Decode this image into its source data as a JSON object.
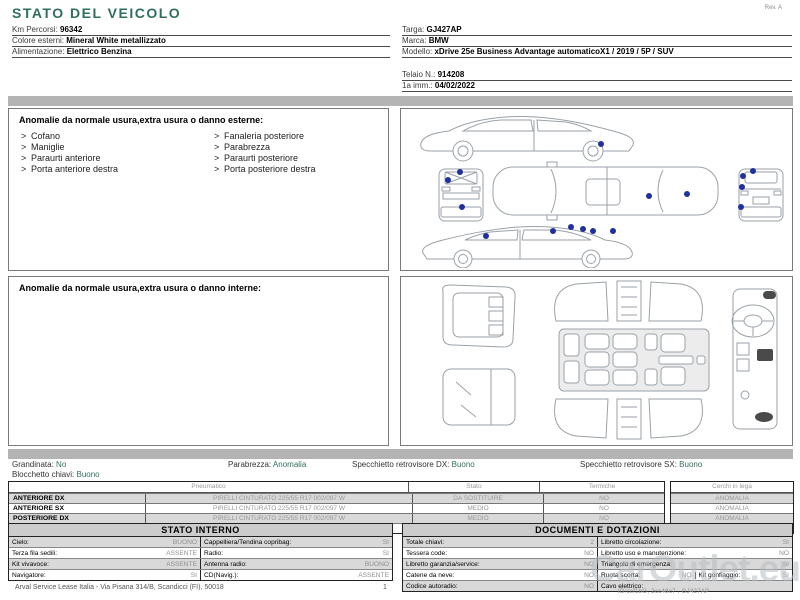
{
  "page": {
    "rev": "Rev. A"
  },
  "title": "STATO DEL VEICOLO",
  "info_left": [
    {
      "label": "Km Percorsi:",
      "value": "96342"
    },
    {
      "label": "Colore esterni:",
      "value": "Mineral White metallizzato"
    },
    {
      "label": "Alimentazione:",
      "value": "Elettrico Benzina"
    }
  ],
  "info_right": [
    {
      "label": "Targa:",
      "value": "GJ427AP"
    },
    {
      "label": "Marca:",
      "value": "BMW"
    },
    {
      "label": "Modello:",
      "value": "xDrive 25e Business Advantage automaticoX1 / 2019 / 5P / SUV"
    },
    {
      "label": "Telaio N.:",
      "value": "914208"
    },
    {
      "label": "1a imm.:",
      "value": "04/02/2022"
    }
  ],
  "exterior": {
    "heading": "Anomalie da normale usura,extra usura o danno esterne:",
    "marker": ">",
    "items_left": [
      "Cofano",
      "Maniglie",
      "Paraurti anteriore",
      "Porta anteriore destra"
    ],
    "items_right": [
      "Fanaleria posteriore",
      "Parabrezza",
      "Paraurti posteriore",
      "Porta posteriore destra"
    ]
  },
  "interior": {
    "heading": "Anomalie da normale usura,extra usura o danno interne:"
  },
  "summary": {
    "grandinata_label": "Grandinata:",
    "grandinata_value": "No",
    "blocchetto_label": "Blocchetto chiavi:",
    "blocchetto_value": "Buono",
    "parabrezza_label": "Parabrezza:",
    "parabrezza_value": "Anomalia",
    "specchietto_dx_label": "Specchietto retrovisore DX:",
    "specchietto_dx_value": "Buono",
    "specchietto_sx_label": "Specchietto retrovisore SX:",
    "specchietto_sx_value": "Buono"
  },
  "tyres": {
    "header_pneumatico": "Pneumatico",
    "header_stato": "Stato",
    "header_termiche": "Termiche",
    "header_cerchi": "Cerchi in lega",
    "rows": [
      {
        "position": "ANTERIORE DX",
        "tyre": "PIRELLI CINTURATO  225/55 R17 002/097 W",
        "stato": "DA SOSTITUIRE",
        "termiche": "NO",
        "cerchi": "ANOMALIA"
      },
      {
        "position": "ANTERIORE SX",
        "tyre": "PIRELLI CINTURATO  225/55 R17 002/097 W",
        "stato": "MEDIO",
        "termiche": "NO",
        "cerchi": "ANOMALIA"
      },
      {
        "position": "POSTERIORE DX",
        "tyre": "PIRELLI CINTURATO  225/55 R17 002/097 W",
        "stato": "MEDIO",
        "termiche": "NO",
        "cerchi": "ANOMALIA"
      },
      {
        "position": "POSTERIORE SX",
        "tyre": "PIRELLI CINTURATO  225/55 R17 002/097 W",
        "stato": "MEDIO",
        "termiche": "NO",
        "cerchi": "BUONO"
      }
    ]
  },
  "stato_interno": {
    "title": "STATO INTERNO",
    "rows": [
      [
        {
          "label": "Cielo:",
          "value": "BUONO"
        },
        {
          "label": "Cappelliera/Tendina copribag:",
          "value": "SI"
        }
      ],
      [
        {
          "label": "Terza fila sedili:",
          "value": "ASSENTE"
        },
        {
          "label": "Radio:",
          "value": "SI"
        }
      ],
      [
        {
          "label": "Kit vivavoce:",
          "value": "ASSENTE"
        },
        {
          "label": "Antenna radio:",
          "value": "BUONO"
        }
      ],
      [
        {
          "label": "Navigatore:",
          "value": "SI"
        },
        {
          "label": "CD(Navig.):",
          "value": "ASSENTE"
        }
      ]
    ]
  },
  "documenti": {
    "title": "DOCUMENTI E DOTAZIONI",
    "rows": [
      {
        "left": [
          {
            "label": "Totale chiavi:",
            "value": "2"
          }
        ],
        "right": [
          {
            "label": "Libretto circolazione:",
            "value": "SI"
          }
        ]
      },
      {
        "left": [
          {
            "label": "Tessera code:",
            "value": "NO"
          }
        ],
        "right": [
          {
            "label": "Libretto uso e manutenzione:",
            "value": "NO"
          }
        ]
      },
      {
        "left": [
          {
            "label": "Libretto garanzia/service:",
            "value": "NO"
          }
        ],
        "right": [
          {
            "label": "Triangolo di emergenza:",
            "value": "SI"
          }
        ]
      },
      {
        "left": [
          {
            "label": "Catene da neve:",
            "value": "NO"
          }
        ],
        "right": [
          {
            "label": "Ruota scorta:",
            "value": "NO"
          },
          {
            "label": "Kit gonfiaggio:",
            "value": "SI"
          }
        ]
      },
      {
        "left": [
          {
            "label": "Codice autoradio:",
            "value": "NO"
          }
        ],
        "right": [
          {
            "label": "Cavo elettrico:",
            "value": ""
          }
        ]
      }
    ]
  },
  "footer": {
    "address": "Arval Service Lease Italia - Via Pisana 314/B, Scandicci (FI), 50018",
    "page_number": "1",
    "watermark": "CarOutlet.eu",
    "doc_id": "ID:ccf1bG, 2cc48c7 , GJ427AP"
  }
}
